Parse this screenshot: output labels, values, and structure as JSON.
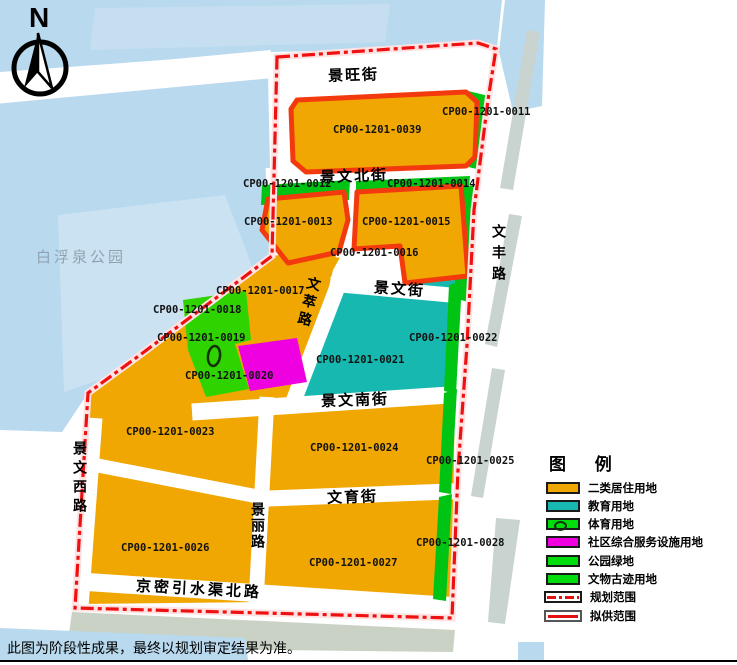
{
  "compass": {
    "label": "N"
  },
  "map": {
    "park_label": "白浮泉公园",
    "streets": {
      "jingwang_st": "景旺街",
      "jingwenbei_st": "景文北街",
      "jingwen_st": "景文街",
      "wencui_rd": "文萃路",
      "jingwennan_st": "景文南街",
      "wenyu_st": "文育街",
      "jingmi_rd": "京密引水渠北路",
      "jingwenxi_rd": "景文西路",
      "jingli_rd": "景丽路",
      "wenfeng_rd": "文丰路"
    },
    "parcels": [
      {
        "code": "CP00-1201-0039",
        "land_use": "二类居住用地"
      },
      {
        "code": "CP00-1201-0011",
        "land_use": "公园绿地"
      },
      {
        "code": "CP00-1201-0012",
        "land_use": "公园绿地"
      },
      {
        "code": "CP00-1201-0013",
        "land_use": "二类居住用地"
      },
      {
        "code": "CP00-1201-0014",
        "land_use": "公园绿地"
      },
      {
        "code": "CP00-1201-0015",
        "land_use": "二类居住用地"
      },
      {
        "code": "CP00-1201-0016",
        "land_use": "二类居住用地"
      },
      {
        "code": "CP00-1201-0017",
        "land_use": "二类居住用地"
      },
      {
        "code": "CP00-1201-0018",
        "land_use": "公园绿地"
      },
      {
        "code": "CP00-1201-0019",
        "land_use": "体育用地"
      },
      {
        "code": "CP00-1201-0020",
        "land_use": "社区综合服务设施用地"
      },
      {
        "code": "CP00-1201-0021",
        "land_use": "教育用地"
      },
      {
        "code": "CP00-1201-0022",
        "land_use": "教育用地"
      },
      {
        "code": "CP00-1201-0023",
        "land_use": "二类居住用地"
      },
      {
        "code": "CP00-1201-0024",
        "land_use": "二类居住用地"
      },
      {
        "code": "CP00-1201-0025",
        "land_use": "公园绿地"
      },
      {
        "code": "CP00-1201-0026",
        "land_use": "二类居住用地"
      },
      {
        "code": "CP00-1201-0027",
        "land_use": "二类居住用地"
      },
      {
        "code": "CP00-1201-0028",
        "land_use": "公园绿地"
      }
    ],
    "colors": {
      "residential": "#F0A702",
      "education": "#17B8B0",
      "sports_green": "#2ED300",
      "community": "#EE00E0",
      "green_space": "#00C414",
      "plan_boundary": "#EE1111",
      "supply_boundary": "#F33A0E",
      "water": "#B9D9EE"
    }
  },
  "legend": {
    "title": "图 例",
    "items": [
      {
        "label": "二类居住用地",
        "swatch": "#F0A702"
      },
      {
        "label": "教育用地",
        "swatch": "#17B8B0"
      },
      {
        "label": "体育用地",
        "swatch": "#00DC0C"
      },
      {
        "label": "社区综合服务设施用地",
        "swatch": "#EE00E0"
      },
      {
        "label": "公园绿地",
        "swatch": "#00DC0C"
      },
      {
        "label": "文物古迹用地",
        "swatch": "#00DC0C"
      },
      {
        "label": "规划范围",
        "swatch": "red-dash-dot-line"
      },
      {
        "label": "拟供范围",
        "swatch": "red-solid-line"
      }
    ]
  },
  "note": "此图为阶段性成果，最终以规划审定结果为准。"
}
